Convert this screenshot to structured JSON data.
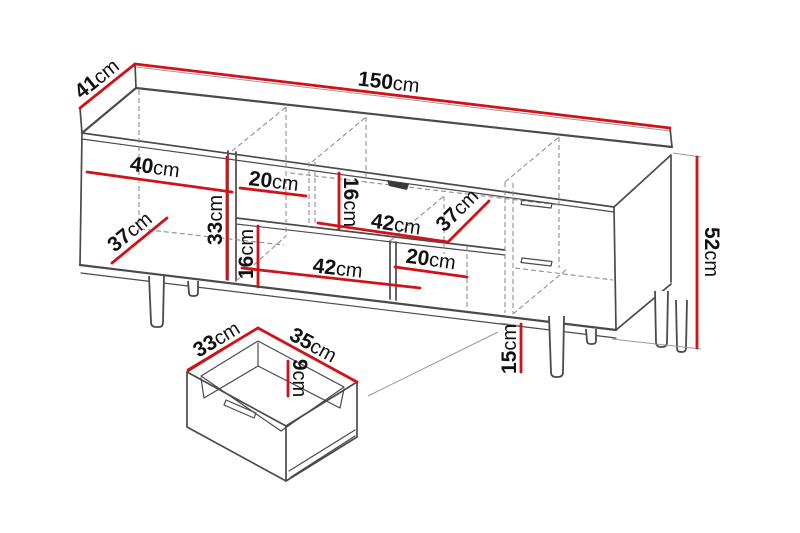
{
  "colors": {
    "dimension_red": "#d11219",
    "outline_gray": "#4a4a4a",
    "hidden_gray": "#8f8f8f",
    "notch_dark": "#3a3a3a",
    "text_black": "#111111",
    "background": "#ffffff"
  },
  "unit": "cm",
  "diagram_type": "furniture-dimension-drawing",
  "dimensions": [
    {
      "id": "total-width",
      "value": "150",
      "unit": "cm",
      "x1": 135,
      "y1": 64,
      "x2": 670,
      "y2": 128,
      "lx": 388,
      "ly": 89,
      "rot": 6.8
    },
    {
      "id": "total-depth",
      "value": "41",
      "unit": "cm",
      "x1": 80,
      "y1": 108,
      "x2": 135,
      "y2": 64,
      "lx": 101,
      "ly": 84,
      "rot": -38.7
    },
    {
      "id": "total-height",
      "value": "52",
      "unit": "cm",
      "x1": 697,
      "y1": 157,
      "x2": 697,
      "y2": 348,
      "lx": 705,
      "ly": 252,
      "rot": 90
    },
    {
      "id": "left-compartment-width",
      "value": "40",
      "unit": "cm",
      "x1": 87,
      "y1": 172,
      "x2": 232,
      "y2": 192,
      "lx": 154,
      "ly": 174,
      "rot": 7.9
    },
    {
      "id": "upper-middle-width",
      "value": "20",
      "unit": "cm",
      "x1": 240,
      "y1": 188,
      "x2": 306,
      "y2": 196,
      "lx": 273,
      "ly": 188,
      "rot": 6.9
    },
    {
      "id": "upper-middle-height",
      "value": "16",
      "unit": "cm",
      "x1": 339,
      "y1": 173,
      "x2": 339,
      "y2": 229,
      "lx": 344,
      "ly": 202,
      "rot": 90
    },
    {
      "id": "middle-shelf-width",
      "value": "42",
      "unit": "cm",
      "x1": 318,
      "y1": 223,
      "x2": 448,
      "y2": 242,
      "lx": 395,
      "ly": 231,
      "rot": 8.3
    },
    {
      "id": "middle-shelf-depth",
      "value": "37",
      "unit": "cm",
      "x1": 448,
      "y1": 242,
      "x2": 489,
      "y2": 201,
      "lx": 462,
      "ly": 215,
      "rot": -45
    },
    {
      "id": "left-compartment-depth",
      "value": "37",
      "unit": "cm",
      "x1": 112,
      "y1": 263,
      "x2": 167,
      "y2": 218,
      "lx": 134,
      "ly": 237,
      "rot": -39.3
    },
    {
      "id": "left-compartment-height",
      "value": "33",
      "unit": "cm",
      "x1": 227,
      "y1": 157,
      "x2": 227,
      "y2": 279,
      "lx": 222,
      "ly": 220,
      "rot": -90
    },
    {
      "id": "lower-middle-height",
      "value": "16",
      "unit": "cm",
      "x1": 258,
      "y1": 226,
      "x2": 258,
      "y2": 287,
      "lx": 253,
      "ly": 254,
      "rot": -90
    },
    {
      "id": "lower-middle-width",
      "value": "42",
      "unit": "cm",
      "x1": 242,
      "y1": 268,
      "x2": 420,
      "y2": 288,
      "lx": 337,
      "ly": 275,
      "rot": 6.4
    },
    {
      "id": "lower-right-width",
      "value": "20",
      "unit": "cm",
      "x1": 395,
      "y1": 267,
      "x2": 467,
      "y2": 277,
      "lx": 430,
      "ly": 266,
      "rot": 7.9
    },
    {
      "id": "leg-height",
      "value": "15",
      "unit": "cm",
      "x1": 521,
      "y1": 324,
      "x2": 521,
      "y2": 372,
      "lx": 516,
      "ly": 349,
      "rot": -90
    },
    {
      "id": "drawer-depth",
      "value": "33",
      "unit": "cm",
      "x1": 188,
      "y1": 370,
      "x2": 258,
      "y2": 328,
      "lx": 220,
      "ly": 345,
      "rot": -31
    },
    {
      "id": "drawer-width",
      "value": "35",
      "unit": "cm",
      "x1": 258,
      "y1": 328,
      "x2": 357,
      "y2": 382,
      "lx": 310,
      "ly": 351,
      "rot": 28.6
    },
    {
      "id": "drawer-height",
      "value": "9",
      "unit": "cm",
      "x1": 288,
      "y1": 361,
      "x2": 288,
      "y2": 396,
      "lx": 293,
      "ly": 378,
      "rot": 90
    }
  ]
}
